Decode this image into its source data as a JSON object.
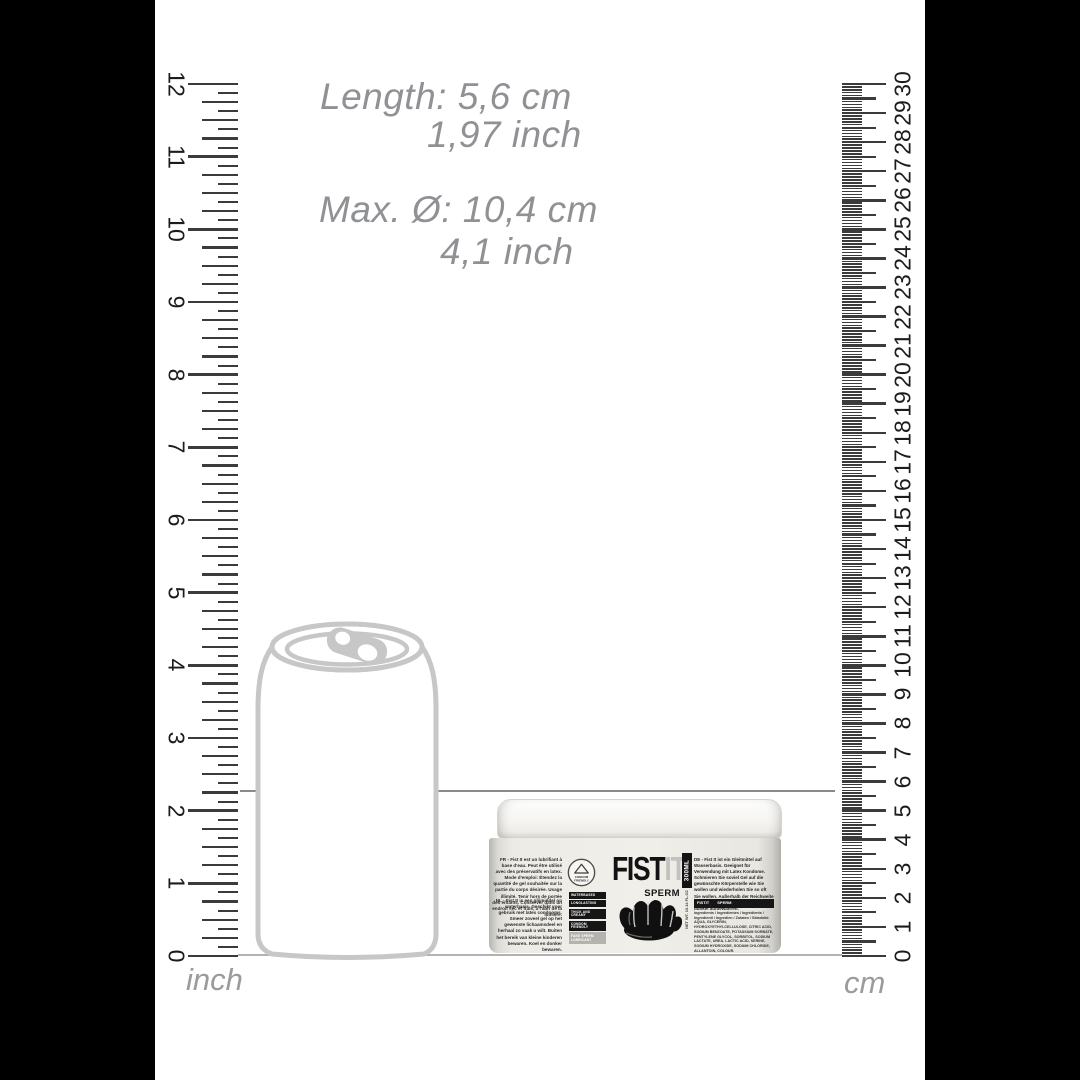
{
  "scene": "product-size-infographic",
  "colors": {
    "pillarbox": "#000000",
    "background": "#ffffff",
    "annotation_text": "#8f9194",
    "ruler_tick": "#3b3b3b",
    "ruler_number": "#1c1c1c",
    "ruler_label": "#9b9b9b",
    "can_outline": "#c7c7c7",
    "measure_line": "#8a8a8a",
    "baseline": "#b2b2b2",
    "badge_black": "#161616",
    "badge_light": "#b5b3ae"
  },
  "size_annotations": {
    "length_line1": "Length: 5,6 cm",
    "length_line2": "1,97 inch",
    "diameter_line1": "Max. Ø: 10,4 cm",
    "diameter_line2": "4,1 inch"
  },
  "inch_ruler": {
    "label": "inch",
    "min": 0,
    "max": 12,
    "numbers": [
      0,
      1,
      2,
      3,
      4,
      5,
      6,
      7,
      8,
      9,
      10,
      11,
      12
    ],
    "subdivisions_per_unit": 8
  },
  "cm_ruler": {
    "label": "cm",
    "min": 0,
    "max": 30,
    "numbers": [
      0,
      1,
      2,
      3,
      4,
      5,
      6,
      7,
      8,
      9,
      10,
      11,
      12,
      13,
      14,
      15,
      16,
      17,
      18,
      19,
      20,
      21,
      22,
      23,
      24,
      25,
      26,
      27,
      28,
      29,
      30
    ],
    "subdivisions_per_unit": 10
  },
  "reference_object": "beverage-can-outline",
  "product": {
    "brand_part1": "FIST",
    "brand_part2": "IT",
    "variant": "SPERM",
    "volume": "300ML",
    "net_weight": "NET WT. 10.14 FL.OZ",
    "badges": [
      "WATERBASED",
      "LONGLASTING",
      "THICK AND CREAMY",
      "CONDOM FRIENDLY"
    ],
    "badge_light_line1": "FAKE SPERM",
    "badge_light_line2": "LUBRICANT",
    "seal_line1": "CONDOM",
    "seal_line2": "FRIENDLY",
    "text_fr": "FR - Fist It est un lubrifiant à base d'eau. Peut être utilisé avec des préservatifs en latex. Mode d'emploi: Étendez la quantité de gel souhaitée sur la partie du corps désirée. Usage illimité. Tenir hors de portée des enfants. Conserver dans un endroit sec et frais, à l'abri de la lumière.",
    "text_nl": "NL - Fist It is een glijmiddel op waterbasis. Geschikt voor gebruik met latex condooms. Smeer zoveel gel op het gewenste lichaamsdeel en herhaal zo vaak u wilt. Buiten het bereik van kleine kinderen bewaren. Koel en donker bewaren.",
    "text_de": "DE - Fist It ist ein Gleitmittel auf Wasserbasis. Geeignet für Verwendung mit Latex Kondome. Schmieren Sie soviel Gel auf die gewünschte Körperstelle wie Sie wollen und wiederholen Sie so oft Sie wollen. Außerhalb der Reichweite von Kindern aufbewahren. Kühl und dunkel aufbewahren.",
    "heading_bar_left": "FISTIT",
    "heading_bar_right": "SPERM",
    "ingredients": "Ingredients / Ingredientes / Ingrédients / Ingredienti / Ingredien / Zutaten / Składniki: AQUA, GLYCERIN, HYDROXYETHYLCELLULOSE, CITRIC ACID, SODIUM BENZOATE, POTASSIUM SORBATE, PENTYLENE GLYCOL, SORBITOL, SODIUM LACTATE, UREA, LACTIC ACID, SERINE, SODIUM HYDROXIDE, SODIUM CHLORIDE, ALLANTOIN, COLOUR."
  }
}
